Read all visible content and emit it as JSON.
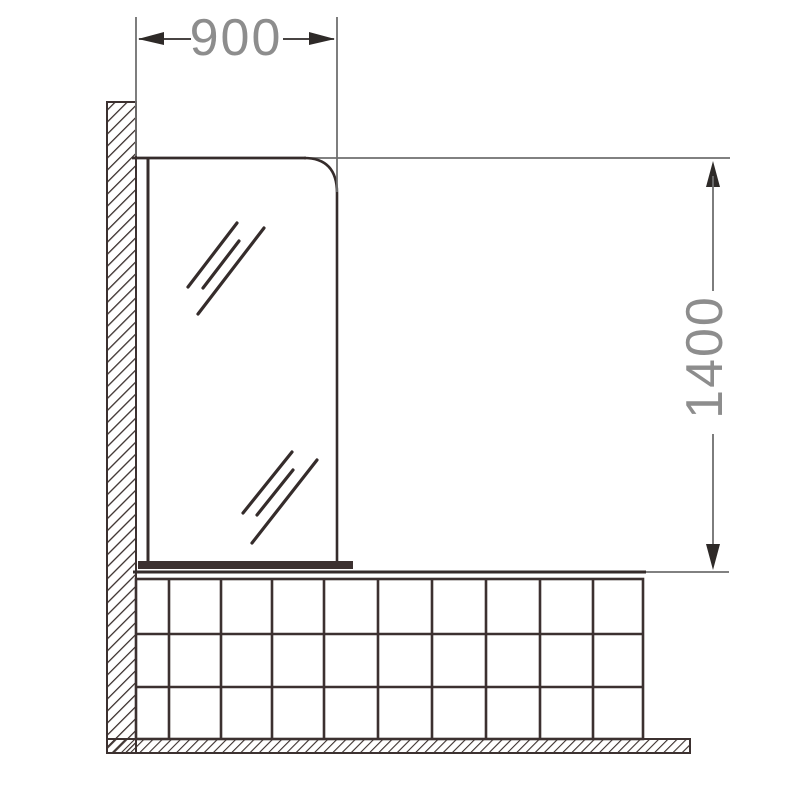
{
  "drawing": {
    "width_dimension_label": "900",
    "height_dimension_label": "1400",
    "parts": [
      "wall",
      "glass-shower-screen",
      "screen-bottom-rail",
      "bath-tile-panel",
      "floor"
    ]
  },
  "colors": {
    "outline": "#3c3130",
    "dimension_line": "#6f6f6f",
    "arrow": "#2e2a28",
    "dimension_text": "#8d8d8d",
    "background": "#ffffff"
  }
}
